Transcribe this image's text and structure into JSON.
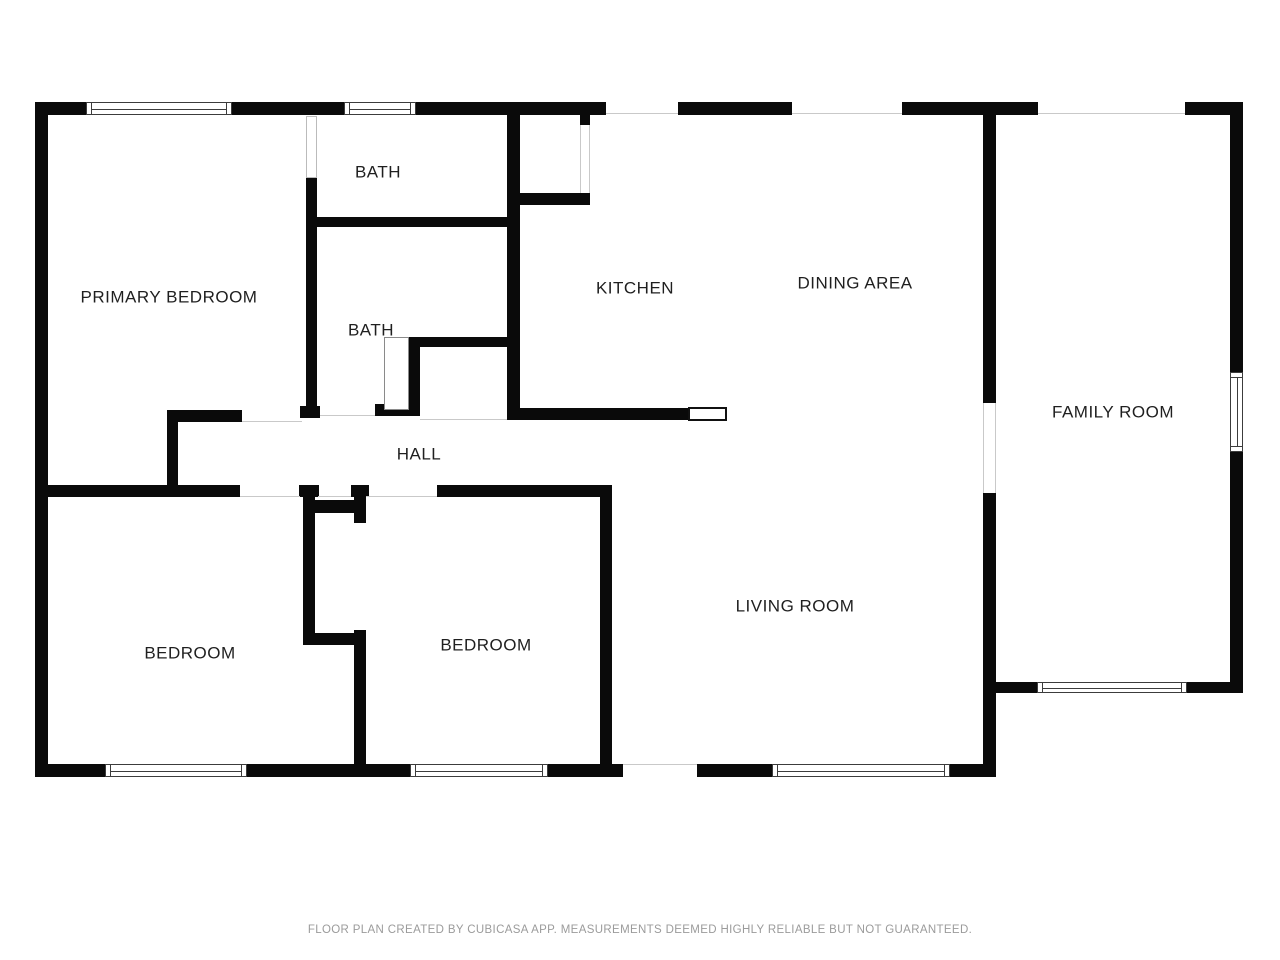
{
  "plan": {
    "rooms": [
      {
        "id": "primary-bedroom",
        "label": "PRIMARY BEDROOM"
      },
      {
        "id": "bath-ensuite",
        "label": "BATH"
      },
      {
        "id": "bath-hall",
        "label": "BATH"
      },
      {
        "id": "kitchen",
        "label": "KITCHEN"
      },
      {
        "id": "dining-area",
        "label": "DINING AREA"
      },
      {
        "id": "family-room",
        "label": "FAMILY ROOM"
      },
      {
        "id": "hall",
        "label": "HALL"
      },
      {
        "id": "bedroom-left",
        "label": "BEDROOM"
      },
      {
        "id": "bedroom-middle",
        "label": "BEDROOM"
      },
      {
        "id": "living-room",
        "label": "LIVING ROOM"
      }
    ]
  },
  "footer": {
    "disclaimer": "FLOOR PLAN CREATED BY CUBICASA APP. MEASUREMENTS DEEMED HIGHLY RELIABLE BUT NOT GUARANTEED."
  },
  "colors": {
    "wall": "#0a0a0a",
    "background": "#ffffff",
    "label_text": "#1f1f1f",
    "footer_text": "#9b9b9b",
    "window_outline": "#3c3c3c",
    "opening_line": "#c9c9c9"
  }
}
